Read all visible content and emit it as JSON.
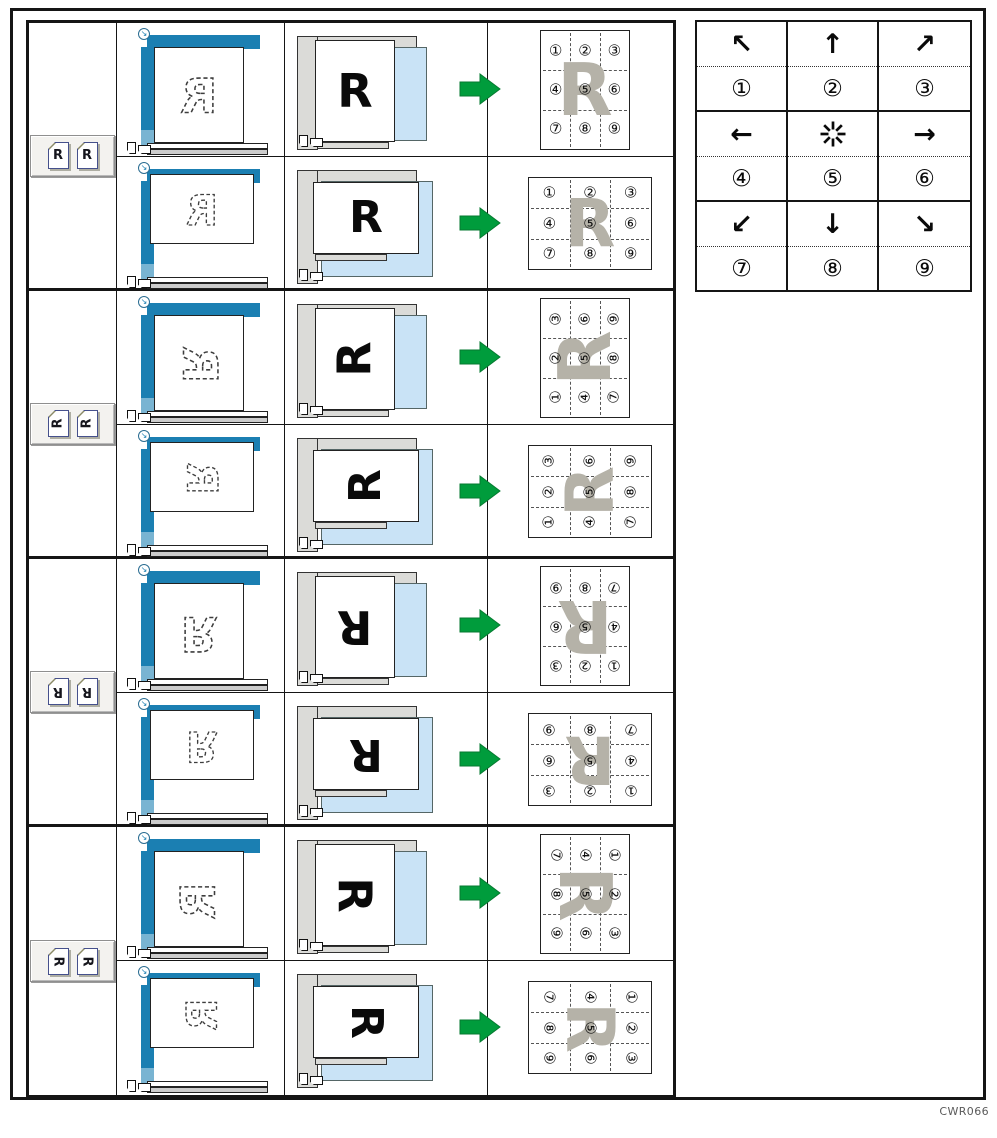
{
  "figure": {
    "code": "CWR066"
  },
  "colors": {
    "platen_blue": "#1b7fb2",
    "platen_blue_light": "#79b4d2",
    "tray_blue": "#c9e3f6",
    "strip_gray": "#dbdbd8",
    "bar_gray": "#cccccc",
    "arrow_green": "#009c3c",
    "watermark_gray": "#b5b2a8",
    "border_black": "#151515"
  },
  "legend": {
    "cells": [
      {
        "icon": "arrow-up-left",
        "glyph": "↖",
        "number": "①"
      },
      {
        "icon": "arrow-up",
        "glyph": "↑",
        "number": "②"
      },
      {
        "icon": "arrow-up-right",
        "glyph": "↗",
        "number": "③"
      },
      {
        "icon": "arrow-left",
        "glyph": "←",
        "number": "④"
      },
      {
        "icon": "center-star",
        "glyph": "",
        "number": "⑤"
      },
      {
        "icon": "arrow-right",
        "glyph": "→",
        "number": "⑥"
      },
      {
        "icon": "arrow-down-left",
        "glyph": "↙",
        "number": "⑦"
      },
      {
        "icon": "arrow-down",
        "glyph": "↓",
        "number": "⑧"
      },
      {
        "icon": "arrow-down-right",
        "glyph": "↘",
        "number": "⑨"
      }
    ]
  },
  "groups": [
    {
      "id": "original-upright",
      "rotation_deg": 0,
      "letter": "R",
      "stamp_grid": [
        [
          "①",
          "②",
          "③"
        ],
        [
          "④",
          "⑤",
          "⑥"
        ],
        [
          "⑦",
          "⑧",
          "⑨"
        ]
      ],
      "rows": [
        {
          "orientation": "portrait"
        },
        {
          "orientation": "landscape"
        }
      ]
    },
    {
      "id": "original-rotated-90-ccw",
      "rotation_deg": -90,
      "letter": "R",
      "stamp_grid": [
        [
          "③",
          "⑥",
          "⑨"
        ],
        [
          "②",
          "⑤",
          "⑧"
        ],
        [
          "①",
          "④",
          "⑦"
        ]
      ],
      "rows": [
        {
          "orientation": "portrait"
        },
        {
          "orientation": "landscape"
        }
      ]
    },
    {
      "id": "original-rotated-180",
      "rotation_deg": 180,
      "letter": "R",
      "stamp_grid": [
        [
          "⑨",
          "⑧",
          "⑦"
        ],
        [
          "⑥",
          "⑤",
          "④"
        ],
        [
          "③",
          "②",
          "①"
        ]
      ],
      "rows": [
        {
          "orientation": "portrait"
        },
        {
          "orientation": "landscape"
        }
      ]
    },
    {
      "id": "original-rotated-90-cw",
      "rotation_deg": 90,
      "letter": "R",
      "stamp_grid": [
        [
          "⑦",
          "④",
          "①"
        ],
        [
          "⑧",
          "⑤",
          "②"
        ],
        [
          "⑨",
          "⑥",
          "③"
        ]
      ],
      "rows": [
        {
          "orientation": "portrait"
        },
        {
          "orientation": "landscape"
        }
      ]
    }
  ]
}
